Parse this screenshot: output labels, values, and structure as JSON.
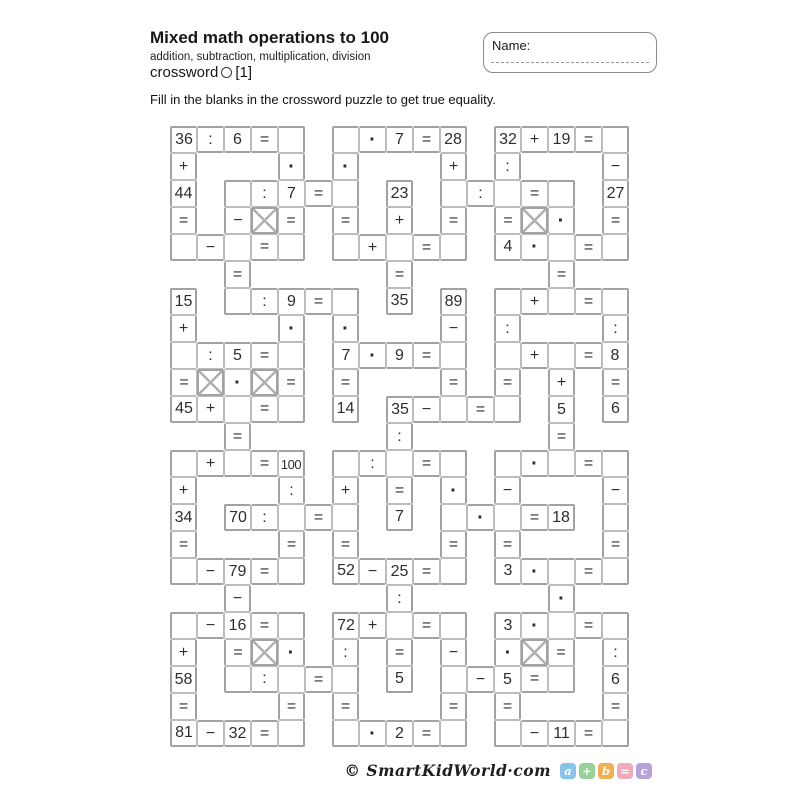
{
  "header": {
    "title": "Mixed math operations to 100",
    "subtitle": "addition, subtraction, multiplication, division",
    "series_prefix": "crossword",
    "series_suffix": "[1]",
    "instruction": "Fill in the blanks in the crossword puzzle to get true equality."
  },
  "name_box": {
    "label": "Name:"
  },
  "grid": {
    "cell_px": 27,
    "line_thin_color": "#bcbcbc",
    "line_thick_color": "#a2a2a2",
    "x_color": "#b0b0b0",
    "rows": [
      [
        "36",
        ":",
        "6",
        "=",
        "",
        null,
        "",
        "·",
        "7",
        "=",
        "28",
        null,
        "32",
        "+",
        "19",
        "=",
        ""
      ],
      [
        "+",
        null,
        null,
        null,
        "·",
        null,
        "·",
        null,
        null,
        null,
        "+",
        null,
        ":",
        null,
        null,
        null,
        "−"
      ],
      [
        "44",
        null,
        "",
        ":",
        "7",
        "=",
        "",
        null,
        "23",
        null,
        "",
        ":",
        "",
        "=",
        "",
        null,
        "27"
      ],
      [
        "=",
        null,
        "−",
        "X",
        "=",
        null,
        "=",
        null,
        "+",
        null,
        "=",
        null,
        "=",
        "X",
        "·",
        null,
        "="
      ],
      [
        "",
        "−",
        "",
        "=",
        "",
        null,
        "",
        "+",
        "",
        "=",
        "",
        null,
        "4",
        "·",
        "",
        "=",
        ""
      ],
      [
        null,
        null,
        "=",
        null,
        null,
        null,
        null,
        null,
        "=",
        null,
        null,
        null,
        null,
        null,
        "=",
        null,
        null
      ],
      [
        "15",
        null,
        "",
        ":",
        "9",
        "=",
        "",
        null,
        "35",
        null,
        "89",
        null,
        "",
        "+",
        "",
        "=",
        ""
      ],
      [
        "+",
        null,
        null,
        null,
        "·",
        null,
        "·",
        null,
        null,
        null,
        "−",
        null,
        ":",
        null,
        null,
        null,
        ":"
      ],
      [
        "",
        ":",
        "5",
        "=",
        "",
        null,
        "7",
        "·",
        "9",
        "=",
        "",
        null,
        "",
        "+",
        "",
        "=",
        "8"
      ],
      [
        "=",
        "X",
        "·",
        "X",
        "=",
        null,
        "=",
        null,
        null,
        null,
        "=",
        null,
        "=",
        null,
        "+",
        null,
        "="
      ],
      [
        "45",
        "+",
        "",
        "=",
        "",
        null,
        "14",
        null,
        "35",
        "−",
        "",
        "=",
        "",
        null,
        "5",
        null,
        "6"
      ],
      [
        null,
        null,
        "=",
        null,
        null,
        null,
        null,
        null,
        ":",
        null,
        null,
        null,
        null,
        null,
        "=",
        null,
        null
      ],
      [
        "",
        "+",
        "",
        "=",
        "100",
        null,
        "",
        ":",
        "",
        "=",
        "",
        null,
        "",
        "·",
        "",
        "=",
        ""
      ],
      [
        "+",
        null,
        null,
        null,
        ":",
        null,
        "+",
        null,
        "=",
        null,
        "·",
        null,
        "−",
        null,
        null,
        null,
        "−"
      ],
      [
        "34",
        null,
        "70",
        ":",
        "",
        "=",
        "",
        null,
        "7",
        null,
        "",
        "·",
        "",
        "=",
        "18",
        null,
        ""
      ],
      [
        "=",
        null,
        null,
        null,
        "=",
        null,
        "=",
        null,
        null,
        null,
        "=",
        null,
        "=",
        null,
        null,
        null,
        "="
      ],
      [
        "",
        "−",
        "79",
        "=",
        "",
        null,
        "52",
        "−",
        "25",
        "=",
        "",
        null,
        "3",
        "·",
        "",
        "=",
        ""
      ],
      [
        null,
        null,
        "−",
        null,
        null,
        null,
        null,
        null,
        ":",
        null,
        null,
        null,
        null,
        null,
        "·",
        null,
        null
      ],
      [
        "",
        "−",
        "16",
        "=",
        "",
        null,
        "72",
        "+",
        "",
        "=",
        "",
        null,
        "3",
        "·",
        "",
        "=",
        ""
      ],
      [
        "+",
        null,
        "=",
        "X",
        "·",
        null,
        ":",
        null,
        "=",
        null,
        "−",
        null,
        "·",
        "X",
        "=",
        null,
        ":"
      ],
      [
        "58",
        null,
        "",
        ":",
        "",
        "=",
        "",
        null,
        "5",
        null,
        "",
        "−",
        "5",
        "=",
        "",
        null,
        "6"
      ],
      [
        "=",
        null,
        null,
        null,
        "=",
        null,
        "=",
        null,
        null,
        null,
        "=",
        null,
        "=",
        null,
        null,
        null,
        "="
      ],
      [
        "81",
        "−",
        "32",
        "=",
        "",
        null,
        "",
        "·",
        "2",
        "=",
        "",
        null,
        "",
        "−",
        "11",
        "=",
        ""
      ]
    ]
  },
  "footer": {
    "credit": "© SmartKidWorld·com",
    "badges": [
      {
        "name": "badge-a",
        "label": "a",
        "color": "#87C4E8"
      },
      {
        "name": "badge-plus",
        "label": "+",
        "color": "#98D19A"
      },
      {
        "name": "badge-b",
        "label": "b",
        "color": "#F2AE54"
      },
      {
        "name": "badge-equals",
        "label": "=",
        "color": "#F1A9BC"
      },
      {
        "name": "badge-c",
        "label": "c",
        "color": "#B5A3D8"
      }
    ]
  }
}
